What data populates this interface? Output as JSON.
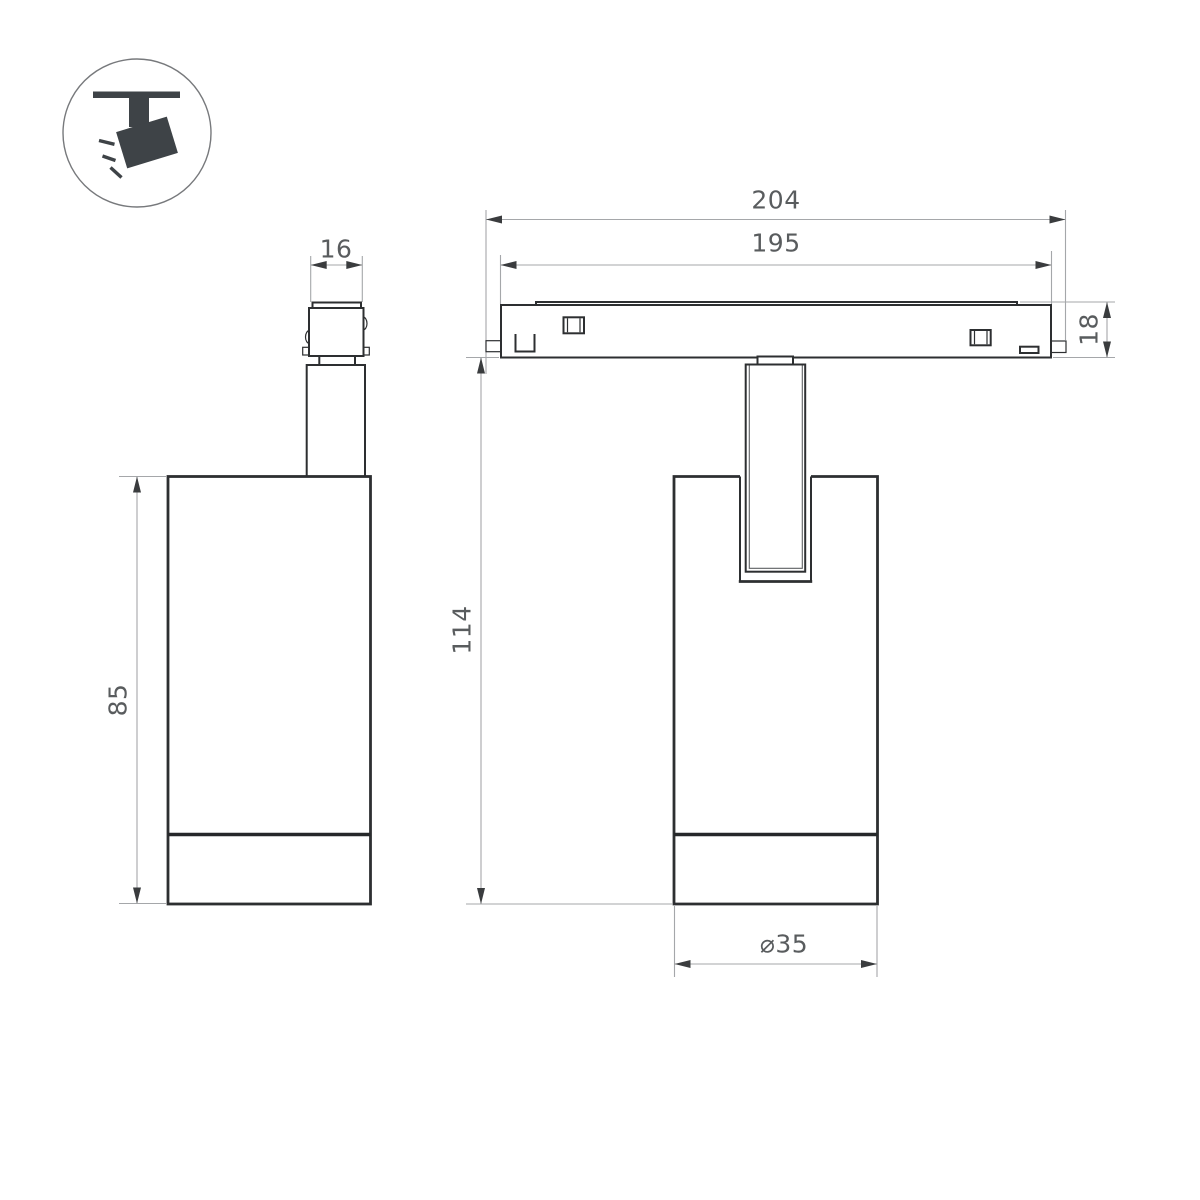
{
  "icon": {
    "name": "ceiling-spotlight"
  },
  "dimensions": {
    "connector_width": "16",
    "lamp_body_height": "85",
    "track_length_outer": "204",
    "track_length_inner": "195",
    "track_height": "18",
    "overall_height": "114",
    "lamp_diameter": "⌀35"
  },
  "colors": {
    "background": "#ffffff",
    "object_line": "#2d2f31",
    "dimension_line": "#a5a7aa",
    "arrow": "#3a3c3e",
    "dimension_text": "#595c5e",
    "icon_fill": "#3e4347"
  }
}
